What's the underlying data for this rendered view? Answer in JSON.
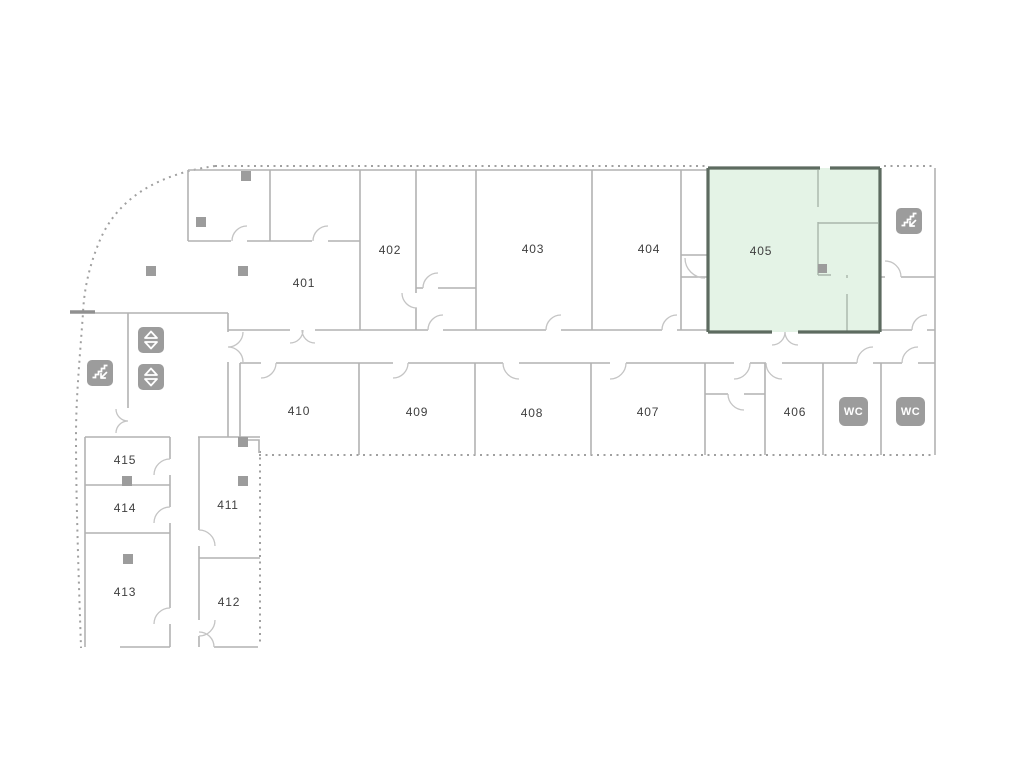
{
  "floor_plan": {
    "selected_room": "405",
    "rooms": [
      {
        "label": "401"
      },
      {
        "label": "402"
      },
      {
        "label": "403"
      },
      {
        "label": "404"
      },
      {
        "label": "405"
      },
      {
        "label": "406"
      },
      {
        "label": "407"
      },
      {
        "label": "408"
      },
      {
        "label": "409"
      },
      {
        "label": "410"
      },
      {
        "label": "411"
      },
      {
        "label": "412"
      },
      {
        "label": "413"
      },
      {
        "label": "414"
      },
      {
        "label": "415"
      }
    ],
    "icons": {
      "wc_label": "WC"
    },
    "colors": {
      "background": "#ffffff",
      "wall": "#b2b2b2",
      "boundary_dotted": "#a0a0a0",
      "highlight_fill": "#e4f3e6",
      "highlight_border": "#5d6b60",
      "icon_background": "#9c9c9c",
      "icon_glyph": "#ffffff",
      "label_text": "#3f3f3f",
      "marker": "#9c9c9c"
    }
  }
}
